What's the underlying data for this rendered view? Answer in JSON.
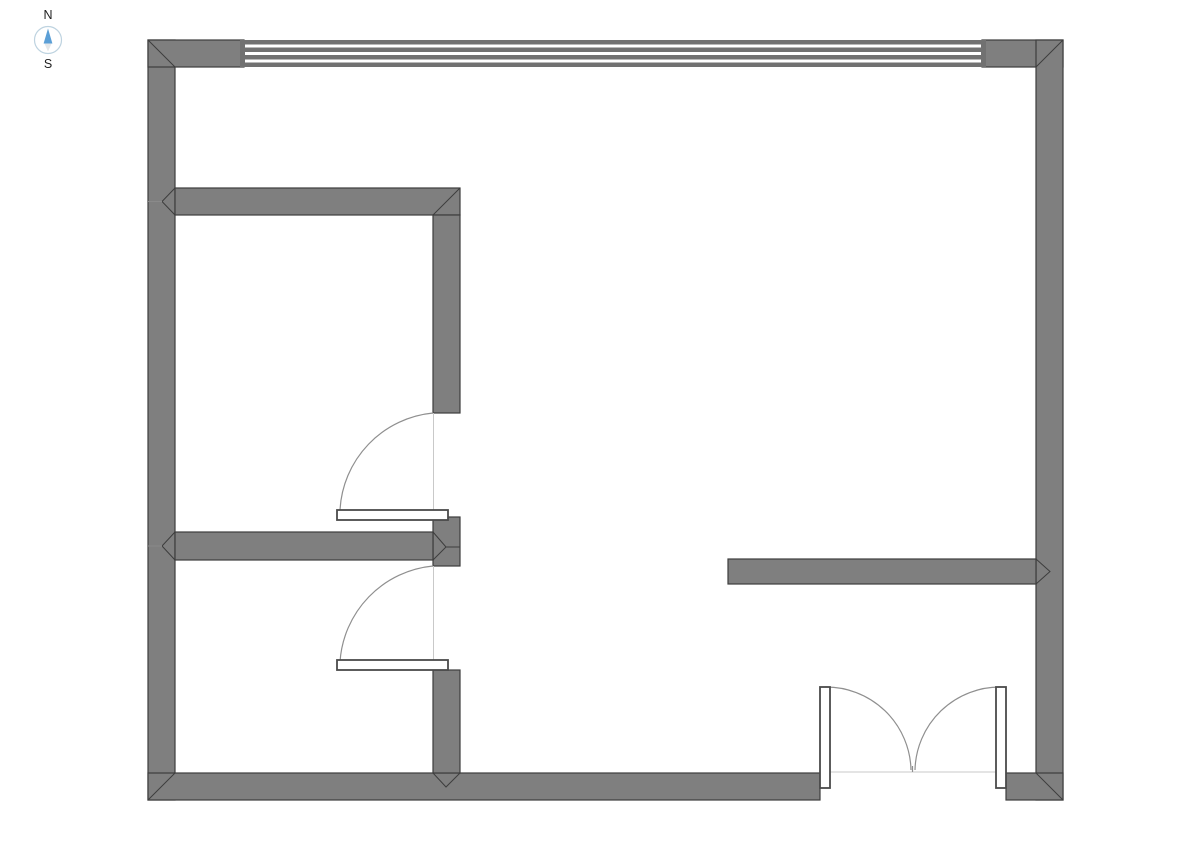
{
  "page": {
    "background_color": "#ffffff"
  },
  "compass": {
    "north_label": "N",
    "south_label": "S",
    "colors": {
      "needle_north": "#5b9fd6",
      "needle_south": "#e4e7e9",
      "ring": "#bed3e0",
      "labels": "#1f1f1f"
    }
  },
  "floorplan": {
    "colors": {
      "wall_fill": "#7f7f7f",
      "wall_stroke": "#3d3d3d",
      "window_stripe": "#717171",
      "window_glass": "#ffffff",
      "door_leaf_fill": "#ffffff",
      "door_leaf_stroke": "#4a4a4a",
      "door_arc": "#8f8f8f",
      "door_chord": "#c9c9c9",
      "junction_tick": "#8a8a8a"
    }
  }
}
